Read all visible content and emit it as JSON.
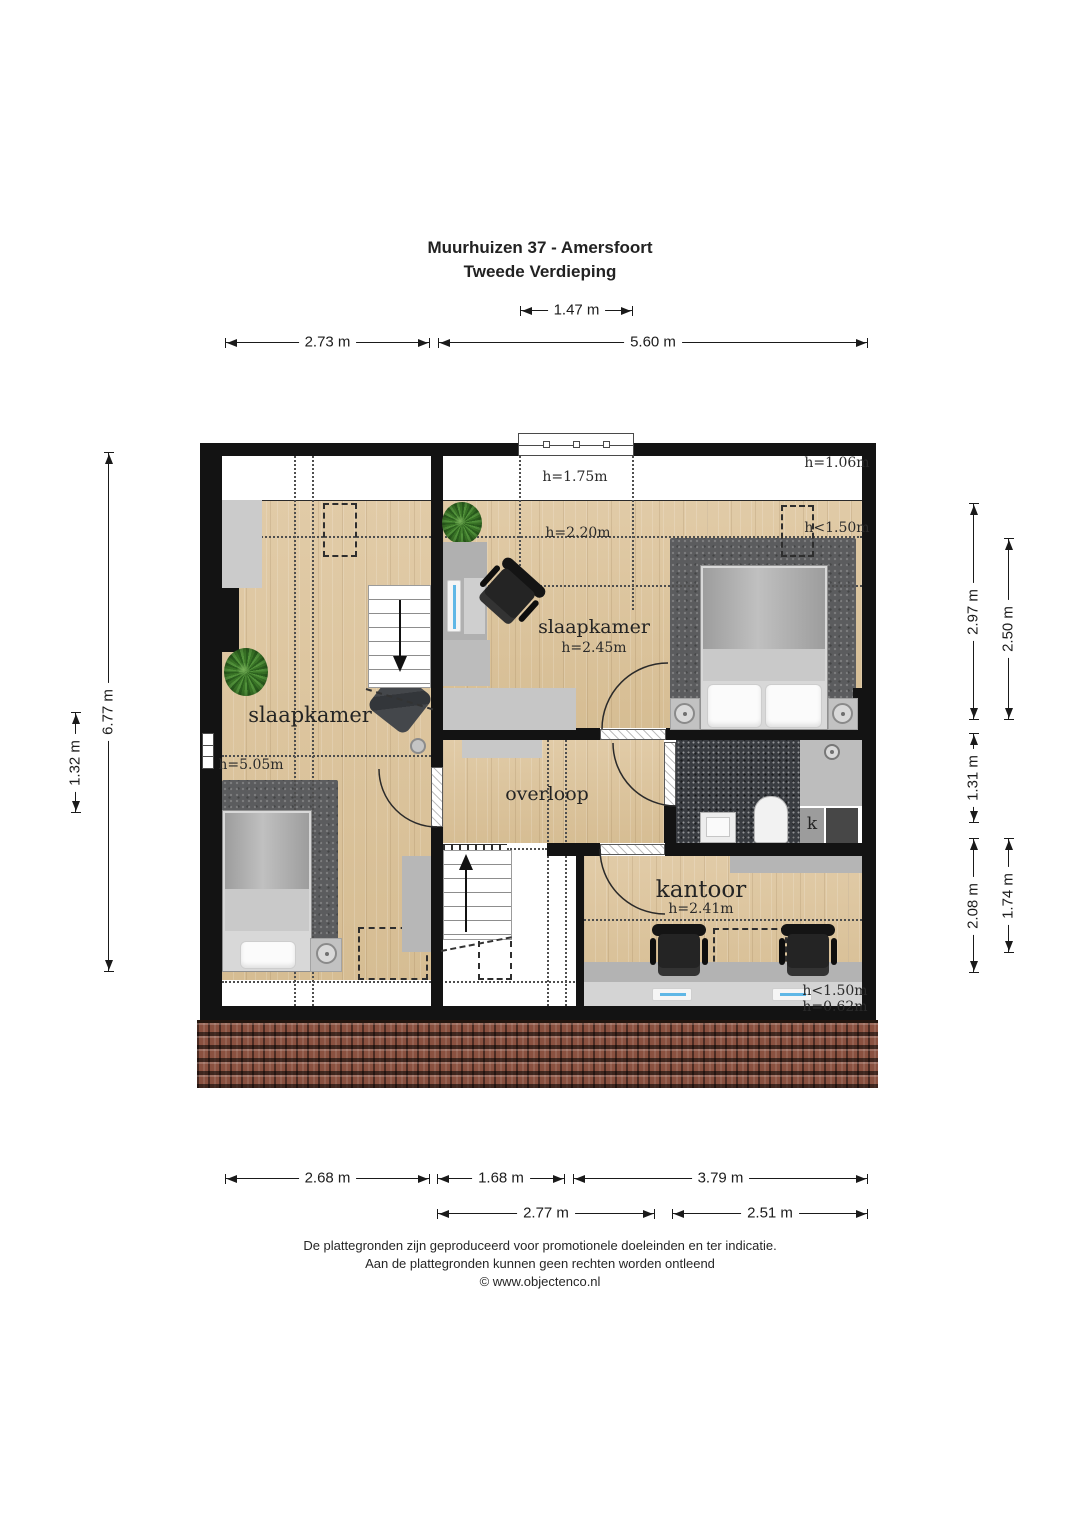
{
  "title": {
    "line1": "Muurhuizen 37 - Amersfoort",
    "line2": "Tweede Verdieping"
  },
  "rooms": {
    "bedroom_left": {
      "label": "slaapkamer",
      "height": "h=5.05m"
    },
    "bedroom_right": {
      "label": "slaapkamer",
      "height": "h=2.45m"
    },
    "landing": {
      "label": "overloop"
    },
    "office": {
      "label": "kantoor",
      "height": "h=2.41m"
    },
    "closet": {
      "label": "k"
    }
  },
  "notes": {
    "window_top": "h=1.75m",
    "ridge": "h=2.20m",
    "top_right": "h=1.06m",
    "dormer_right": "h<1.50m",
    "office_edge": "h<1.50m",
    "office_knee": "h=0.62m"
  },
  "dims": {
    "top_window": "1.47 m",
    "top_left": "2.73 m",
    "top_right": "5.60 m",
    "left_total": "6.77 m",
    "left_inner": "1.32 m",
    "right_1": "2.97 m",
    "right_2": "2.50 m",
    "right_3": "1.31 m",
    "right_4": "2.08 m",
    "right_5": "1.74 m",
    "bottom_1": "2.68 m",
    "bottom_2": "1.68 m",
    "bottom_3": "3.79 m",
    "bottom_4": "2.77 m",
    "bottom_5": "2.51 m"
  },
  "footer": {
    "line1": "De plattegronden zijn geproduceerd voor promotionele doeleinden en ter indicatie.",
    "line2": "Aan de plattegronden kunnen geen rechten worden ontleend",
    "line3": "© www.objectenco.nl"
  },
  "colors": {
    "wall": "#131313",
    "wood": "#dcc49e",
    "rug": "#5b5c5e",
    "roof_tile": "#8a5140",
    "plant_green": "#3a7527"
  }
}
